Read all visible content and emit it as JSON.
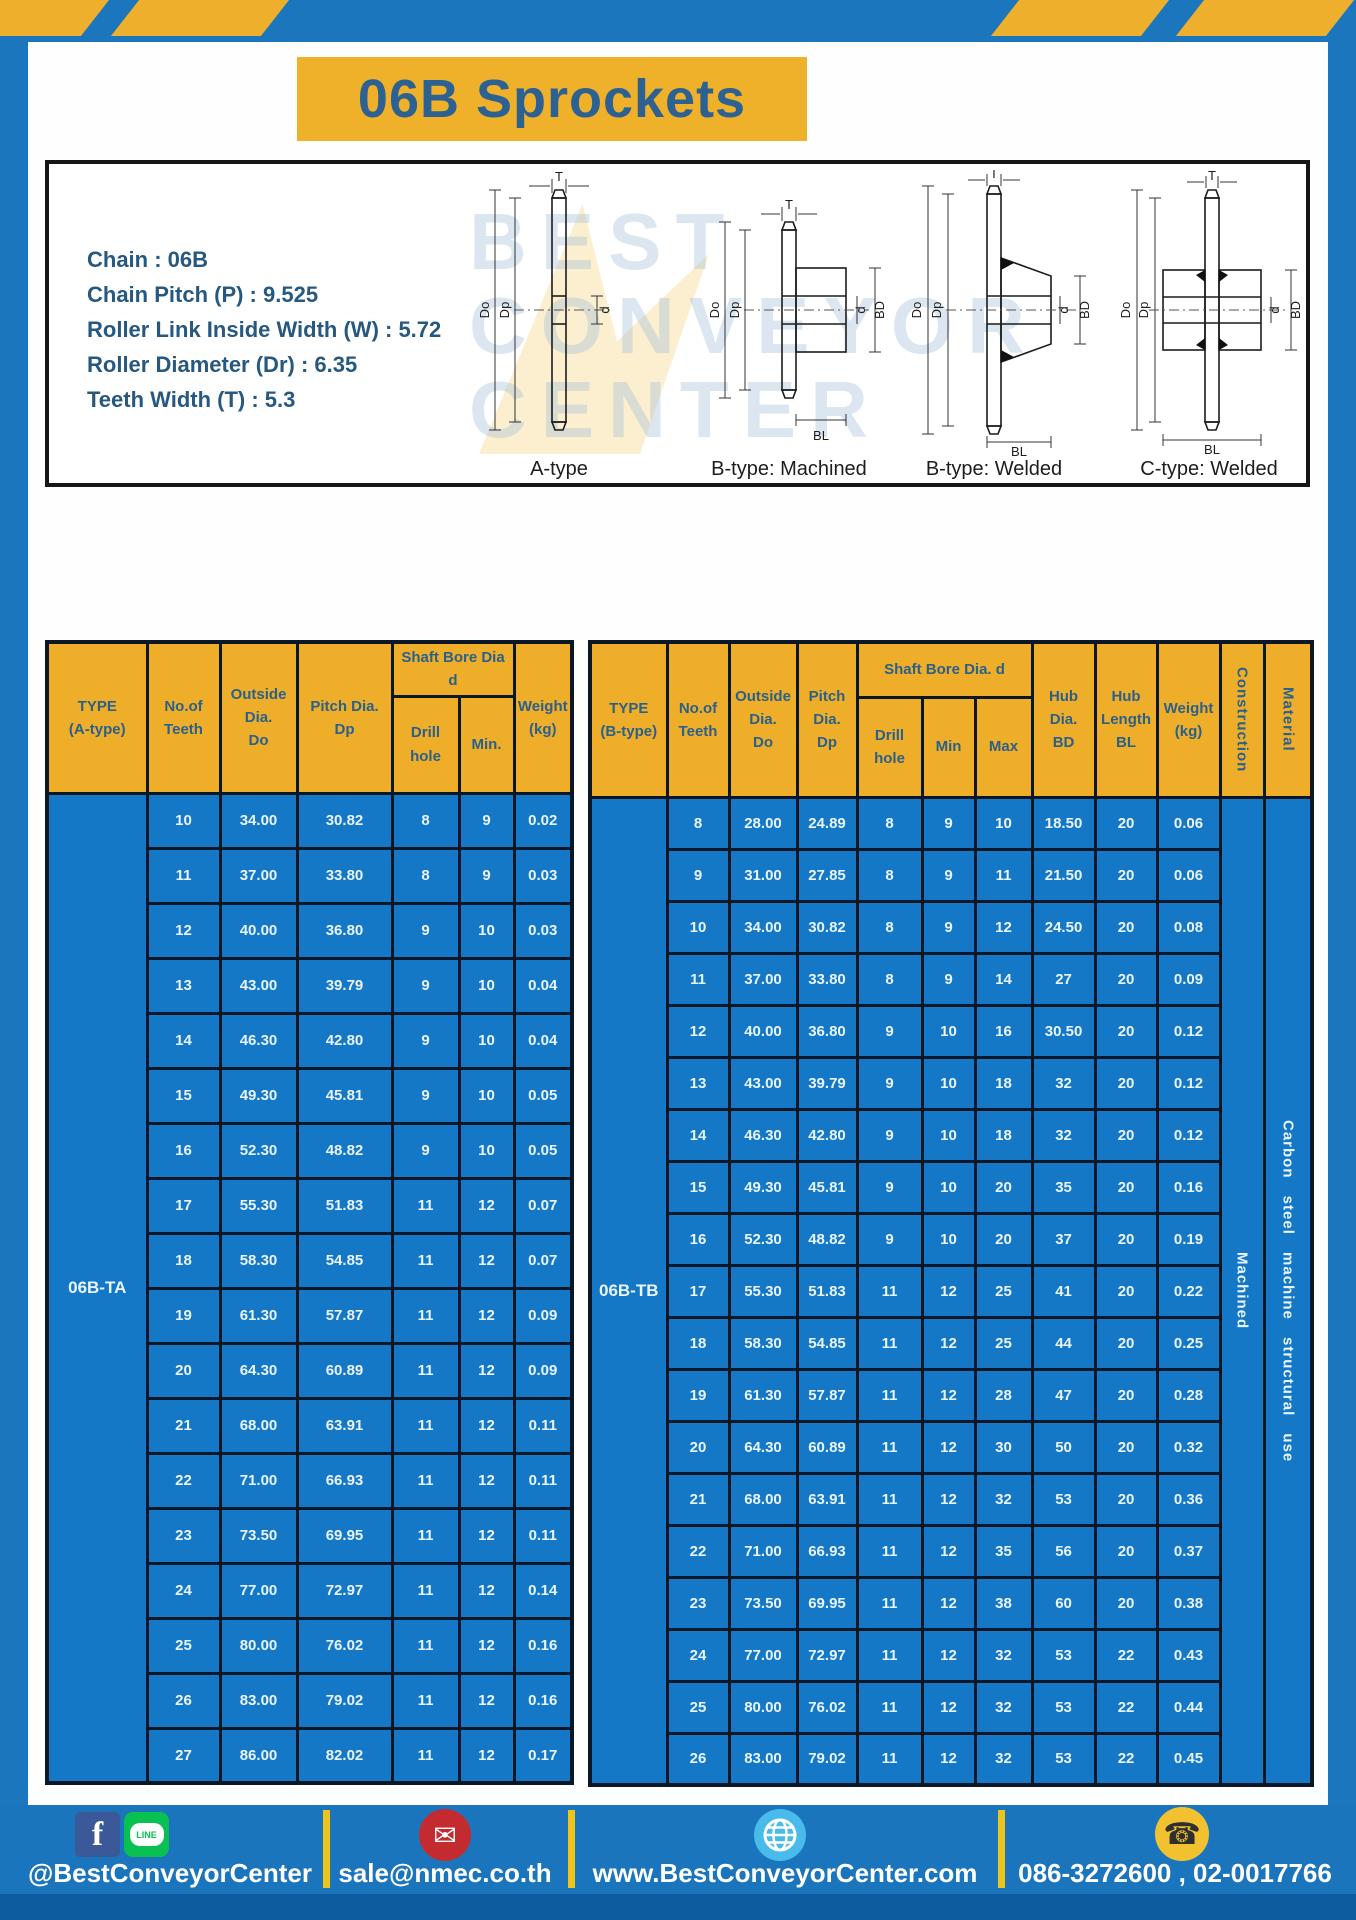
{
  "page": {
    "title": "06B Sprockets",
    "watermark": "BEST\nCONVEYOR\nCENTER"
  },
  "colors": {
    "frame_blue": "#1b76bd",
    "cell_blue": "#1478c6",
    "accent_yellow": "#efb02a",
    "separator_yellow": "#edc419",
    "bottom_strip_blue": "#0d5c9f",
    "heading_text_blue": "#2d6191",
    "cell_text_white": "#e9f4fd"
  },
  "specs": [
    "Chain : 06B",
    "Chain Pitch (P) : 9.525",
    "Roller Link Inside Width (W) : 5.72",
    "Roller Diameter (Dr) : 6.35",
    "Teeth Width (T) : 5.3"
  ],
  "diagram": {
    "dims": {
      "t": "T",
      "do": "Do",
      "dp": "Dp",
      "d": "d",
      "bd": "BD",
      "bl": "BL"
    },
    "types": [
      {
        "label": "A-type"
      },
      {
        "label": "B-type: Machined"
      },
      {
        "label": "B-type: Welded"
      },
      {
        "label": "C-type: Welded"
      }
    ]
  },
  "table_a": {
    "headers": {
      "type": "TYPE\n(A-type)",
      "teeth": "No.of\nTeeth",
      "outside": "Outside\nDia.\nDo",
      "pitch": "Pitch Dia.\nDp",
      "shaft_bore": "Shaft Bore Dia d",
      "drill": "Drill hole",
      "min": "Min.",
      "weight": "Weight\n(kg)"
    },
    "type_label": "06B-TA",
    "rows": [
      [
        "10",
        "34.00",
        "30.82",
        "8",
        "9",
        "0.02"
      ],
      [
        "11",
        "37.00",
        "33.80",
        "8",
        "9",
        "0.03"
      ],
      [
        "12",
        "40.00",
        "36.80",
        "9",
        "10",
        "0.03"
      ],
      [
        "13",
        "43.00",
        "39.79",
        "9",
        "10",
        "0.04"
      ],
      [
        "14",
        "46.30",
        "42.80",
        "9",
        "10",
        "0.04"
      ],
      [
        "15",
        "49.30",
        "45.81",
        "9",
        "10",
        "0.05"
      ],
      [
        "16",
        "52.30",
        "48.82",
        "9",
        "10",
        "0.05"
      ],
      [
        "17",
        "55.30",
        "51.83",
        "11",
        "12",
        "0.07"
      ],
      [
        "18",
        "58.30",
        "54.85",
        "11",
        "12",
        "0.07"
      ],
      [
        "19",
        "61.30",
        "57.87",
        "11",
        "12",
        "0.09"
      ],
      [
        "20",
        "64.30",
        "60.89",
        "11",
        "12",
        "0.09"
      ],
      [
        "21",
        "68.00",
        "63.91",
        "11",
        "12",
        "0.11"
      ],
      [
        "22",
        "71.00",
        "66.93",
        "11",
        "12",
        "0.11"
      ],
      [
        "23",
        "73.50",
        "69.95",
        "11",
        "12",
        "0.11"
      ],
      [
        "24",
        "77.00",
        "72.97",
        "11",
        "12",
        "0.14"
      ],
      [
        "25",
        "80.00",
        "76.02",
        "11",
        "12",
        "0.16"
      ],
      [
        "26",
        "83.00",
        "79.02",
        "11",
        "12",
        "0.16"
      ],
      [
        "27",
        "86.00",
        "82.02",
        "11",
        "12",
        "0.17"
      ]
    ]
  },
  "table_b": {
    "headers": {
      "type": "TYPE\n(B-type)",
      "teeth": "No.of\nTeeth",
      "outside": "Outside\nDia.\nDo",
      "pitch": "Pitch\nDia.\nDp",
      "shaft_bore": "Shaft Bore Dia.  d",
      "drill": "Drill hole",
      "min": "Min",
      "max": "Max",
      "hub_dia": "Hub\nDia.\nBD",
      "hub_len": "Hub\nLength\nBL",
      "weight": "Weight\n(kg)",
      "construction": "Construction",
      "material": "Material"
    },
    "type_label": "06B-TB",
    "construction_value": "Machined",
    "material_value": "Carbon steel machine structural use",
    "rows": [
      [
        "8",
        "28.00",
        "24.89",
        "8",
        "9",
        "10",
        "18.50",
        "20",
        "0.06"
      ],
      [
        "9",
        "31.00",
        "27.85",
        "8",
        "9",
        "11",
        "21.50",
        "20",
        "0.06"
      ],
      [
        "10",
        "34.00",
        "30.82",
        "8",
        "9",
        "12",
        "24.50",
        "20",
        "0.08"
      ],
      [
        "11",
        "37.00",
        "33.80",
        "8",
        "9",
        "14",
        "27",
        "20",
        "0.09"
      ],
      [
        "12",
        "40.00",
        "36.80",
        "9",
        "10",
        "16",
        "30.50",
        "20",
        "0.12"
      ],
      [
        "13",
        "43.00",
        "39.79",
        "9",
        "10",
        "18",
        "32",
        "20",
        "0.12"
      ],
      [
        "14",
        "46.30",
        "42.80",
        "9",
        "10",
        "18",
        "32",
        "20",
        "0.12"
      ],
      [
        "15",
        "49.30",
        "45.81",
        "9",
        "10",
        "20",
        "35",
        "20",
        "0.16"
      ],
      [
        "16",
        "52.30",
        "48.82",
        "9",
        "10",
        "20",
        "37",
        "20",
        "0.19"
      ],
      [
        "17",
        "55.30",
        "51.83",
        "11",
        "12",
        "25",
        "41",
        "20",
        "0.22"
      ],
      [
        "18",
        "58.30",
        "54.85",
        "11",
        "12",
        "25",
        "44",
        "20",
        "0.25"
      ],
      [
        "19",
        "61.30",
        "57.87",
        "11",
        "12",
        "28",
        "47",
        "20",
        "0.28"
      ],
      [
        "20",
        "64.30",
        "60.89",
        "11",
        "12",
        "30",
        "50",
        "20",
        "0.32"
      ],
      [
        "21",
        "68.00",
        "63.91",
        "11",
        "12",
        "32",
        "53",
        "20",
        "0.36"
      ],
      [
        "22",
        "71.00",
        "66.93",
        "11",
        "12",
        "35",
        "56",
        "20",
        "0.37"
      ],
      [
        "23",
        "73.50",
        "69.95",
        "11",
        "12",
        "38",
        "60",
        "20",
        "0.38"
      ],
      [
        "24",
        "77.00",
        "72.97",
        "11",
        "12",
        "32",
        "53",
        "22",
        "0.43"
      ],
      [
        "25",
        "80.00",
        "76.02",
        "11",
        "12",
        "32",
        "53",
        "22",
        "0.44"
      ],
      [
        "26",
        "83.00",
        "79.02",
        "11",
        "12",
        "32",
        "53",
        "22",
        "0.45"
      ]
    ]
  },
  "footer": {
    "line_badge": "LINE",
    "fb_letter": "f",
    "sections": [
      {
        "text": "@BestConveyorCenter"
      },
      {
        "text": "sale@nmec.co.th"
      },
      {
        "text": "www.BestConveyorCenter.com"
      },
      {
        "text": "086-3272600 , 02-0017766"
      }
    ]
  }
}
